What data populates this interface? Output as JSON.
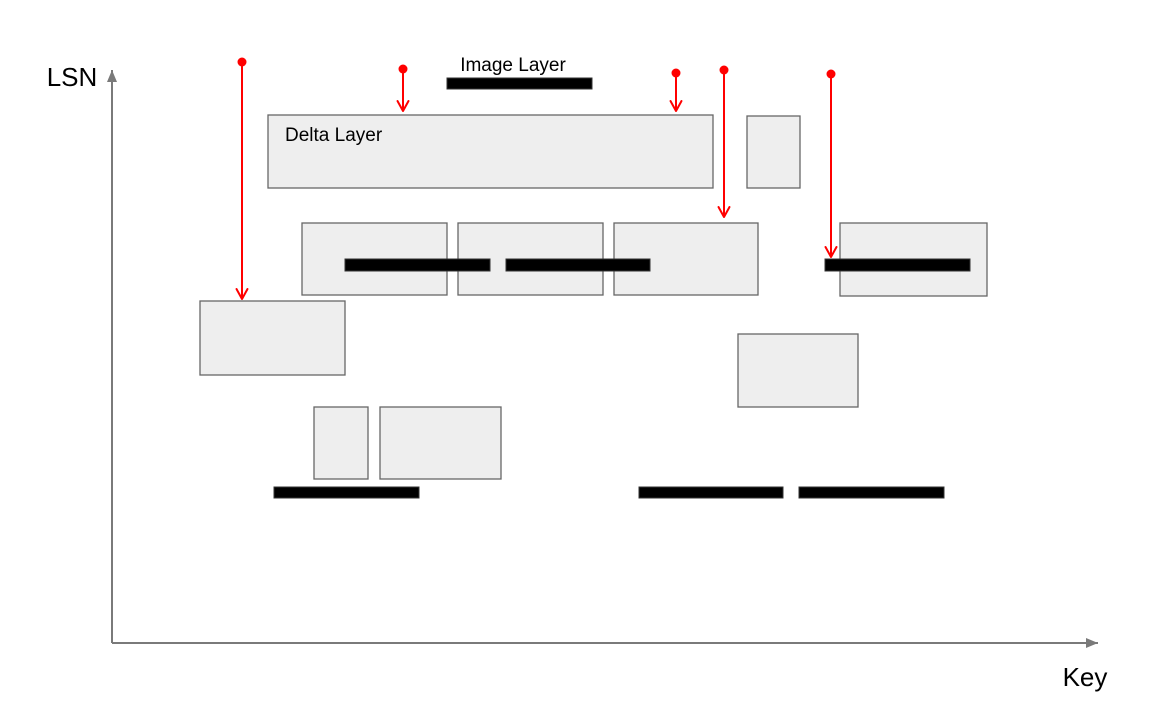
{
  "title": "Layer map diagram",
  "axes": {
    "y_label": "LSN",
    "x_label": "Key",
    "origin": {
      "x": 112,
      "y": 643
    },
    "y_axis_top": 70,
    "x_axis_right": 1098
  },
  "labels": {
    "image_layer": "Image Layer",
    "delta_layer": "Delta Layer"
  },
  "colors": {
    "background": "#ffffff",
    "box_fill": "#eeeeee",
    "box_border": "#666666",
    "bar_fill": "#000000",
    "bar_border": "#333333",
    "arrow_red": "#ff0000",
    "axis_gray": "#7a7a7a",
    "text": "#000000"
  },
  "diagram": {
    "delta_boxes": [
      {
        "name": "delta-layer-main",
        "x": 268,
        "y": 115,
        "w": 445,
        "h": 73
      },
      {
        "name": "delta-layer-small-top",
        "x": 747,
        "y": 116,
        "w": 53,
        "h": 72
      },
      {
        "name": "delta-layer-mid-1",
        "x": 302,
        "y": 223,
        "w": 145,
        "h": 72
      },
      {
        "name": "delta-layer-mid-2",
        "x": 458,
        "y": 223,
        "w": 145,
        "h": 72
      },
      {
        "name": "delta-layer-mid-3",
        "x": 614,
        "y": 223,
        "w": 144,
        "h": 72
      },
      {
        "name": "delta-layer-mid-right",
        "x": 840,
        "y": 223,
        "w": 147,
        "h": 73
      },
      {
        "name": "delta-layer-left",
        "x": 200,
        "y": 301,
        "w": 145,
        "h": 74
      },
      {
        "name": "delta-layer-lower-right",
        "x": 738,
        "y": 334,
        "w": 120,
        "h": 73
      },
      {
        "name": "delta-layer-small-a",
        "x": 314,
        "y": 407,
        "w": 54,
        "h": 72
      },
      {
        "name": "delta-layer-small-b",
        "x": 380,
        "y": 407,
        "w": 121,
        "h": 72
      }
    ],
    "image_bars": [
      {
        "name": "image-layer-legend-bar",
        "x": 447,
        "y": 78,
        "w": 145,
        "h": 11
      },
      {
        "name": "image-layer-bar",
        "x": 345,
        "y": 259,
        "w": 145,
        "h": 12
      },
      {
        "name": "image-layer-bar",
        "x": 506,
        "y": 259,
        "w": 144,
        "h": 12
      },
      {
        "name": "image-layer-bar",
        "x": 825,
        "y": 259,
        "w": 145,
        "h": 12
      },
      {
        "name": "image-layer-bar",
        "x": 274,
        "y": 487,
        "w": 145,
        "h": 11
      },
      {
        "name": "image-layer-bar",
        "x": 639,
        "y": 487,
        "w": 144,
        "h": 11
      },
      {
        "name": "image-layer-bar",
        "x": 799,
        "y": 487,
        "w": 145,
        "h": 11
      }
    ],
    "read_arrows": [
      {
        "name": "read-arrow",
        "x": 242,
        "y_dot": 62,
        "y_tip": 299
      },
      {
        "name": "read-arrow",
        "x": 403,
        "y_dot": 69,
        "y_tip": 111
      },
      {
        "name": "read-arrow",
        "x": 676,
        "y_dot": 73,
        "y_tip": 111
      },
      {
        "name": "read-arrow",
        "x": 724,
        "y_dot": 70,
        "y_tip": 217
      },
      {
        "name": "read-arrow",
        "x": 831,
        "y_dot": 74,
        "y_tip": 257
      }
    ],
    "dot_radius": 4.5,
    "arrow_stroke_width": 2
  }
}
